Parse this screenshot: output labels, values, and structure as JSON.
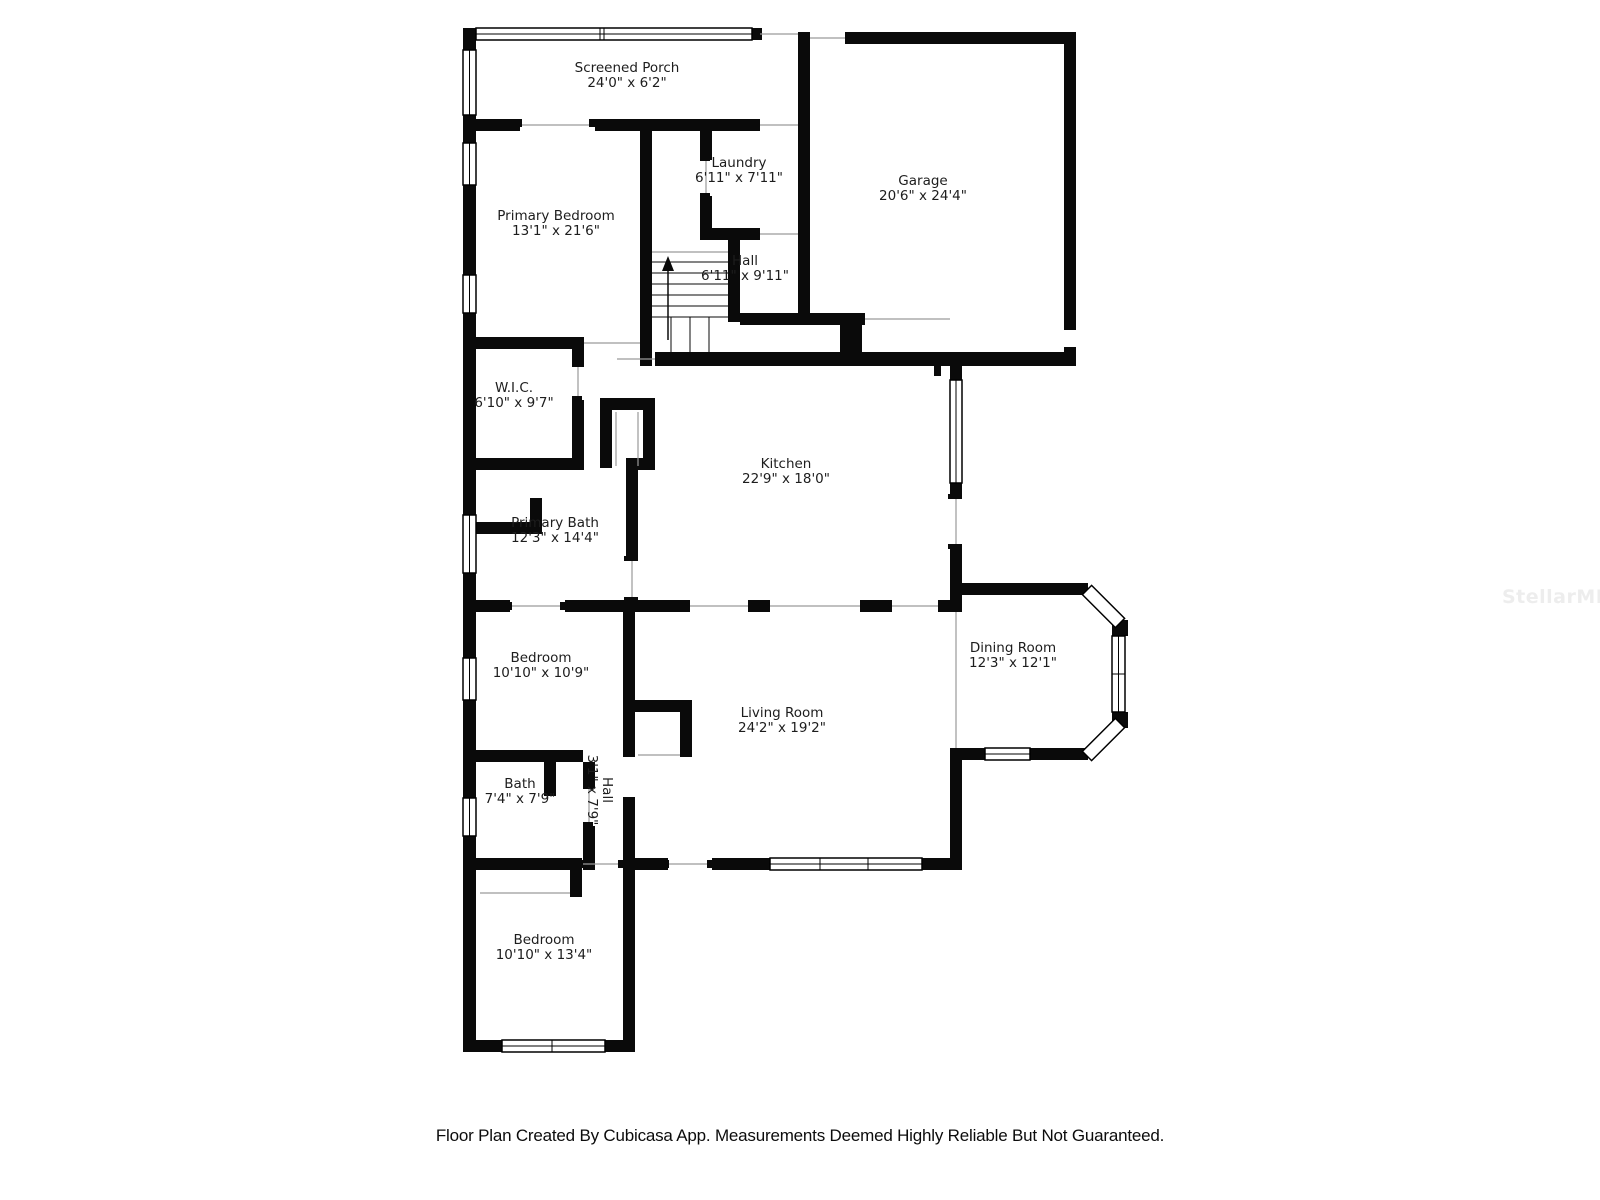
{
  "title": "Floor Plan",
  "colors": {
    "wall": "#0a0a0a",
    "window_stroke": "#000000",
    "open_edge": "#9a9a9a",
    "label_text": "#1d1d1d",
    "footer_text": "#0c0c0c",
    "watermark_text": "#ededed",
    "background": "#ffffff"
  },
  "rooms": [
    {
      "id": "screened-porch",
      "name": "Screened Porch",
      "dims": "24'0\" x 6'2\"",
      "cx": 627,
      "cy": 75,
      "rotate": 0
    },
    {
      "id": "laundry",
      "name": "Laundry",
      "dims": "6'11\" x 7'11\"",
      "cx": 739,
      "cy": 170,
      "rotate": 0
    },
    {
      "id": "garage",
      "name": "Garage",
      "dims": "20'6\" x 24'4\"",
      "cx": 923,
      "cy": 188,
      "rotate": 0
    },
    {
      "id": "primary-bedroom",
      "name": "Primary Bedroom",
      "dims": "13'1\" x 21'6\"",
      "cx": 556,
      "cy": 223,
      "rotate": 0
    },
    {
      "id": "hall-upper",
      "name": "Hall",
      "dims": "6'11\" x 9'11\"",
      "cx": 745,
      "cy": 268,
      "rotate": 0
    },
    {
      "id": "wic",
      "name": "W.I.C.",
      "dims": "6'10\" x 9'7\"",
      "cx": 514,
      "cy": 395,
      "rotate": 0
    },
    {
      "id": "kitchen",
      "name": "Kitchen",
      "dims": "22'9\" x 18'0\"",
      "cx": 786,
      "cy": 471,
      "rotate": 0
    },
    {
      "id": "primary-bath",
      "name": "Primary Bath",
      "dims": "12'3\" x 14'4\"",
      "cx": 555,
      "cy": 530,
      "rotate": 0
    },
    {
      "id": "dining-room",
      "name": "Dining Room",
      "dims": "12'3\" x 12'1\"",
      "cx": 1013,
      "cy": 655,
      "rotate": 0
    },
    {
      "id": "bedroom-middle",
      "name": "Bedroom",
      "dims": "10'10\" x 10'9\"",
      "cx": 541,
      "cy": 665,
      "rotate": 0
    },
    {
      "id": "living-room",
      "name": "Living Room",
      "dims": "24'2\" x 19'2\"",
      "cx": 782,
      "cy": 720,
      "rotate": 0
    },
    {
      "id": "bath",
      "name": "Bath",
      "dims": "7'4\" x 7'9\"",
      "cx": 520,
      "cy": 791,
      "rotate": 0
    },
    {
      "id": "hall-lower",
      "name": "Hall",
      "dims": "3'1\" x 7'9\"",
      "cx": 600,
      "cy": 790,
      "rotate": 90
    },
    {
      "id": "bedroom-bottom",
      "name": "Bedroom",
      "dims": "10'10\" x 13'4\"",
      "cx": 544,
      "cy": 947,
      "rotate": 0
    }
  ],
  "stairs": {
    "direction": "up"
  },
  "footer": {
    "text": "Floor Plan Created By Cubicasa App. Measurements Deemed Highly Reliable But Not Guaranteed."
  },
  "watermark": {
    "text": "StellarMLS"
  }
}
